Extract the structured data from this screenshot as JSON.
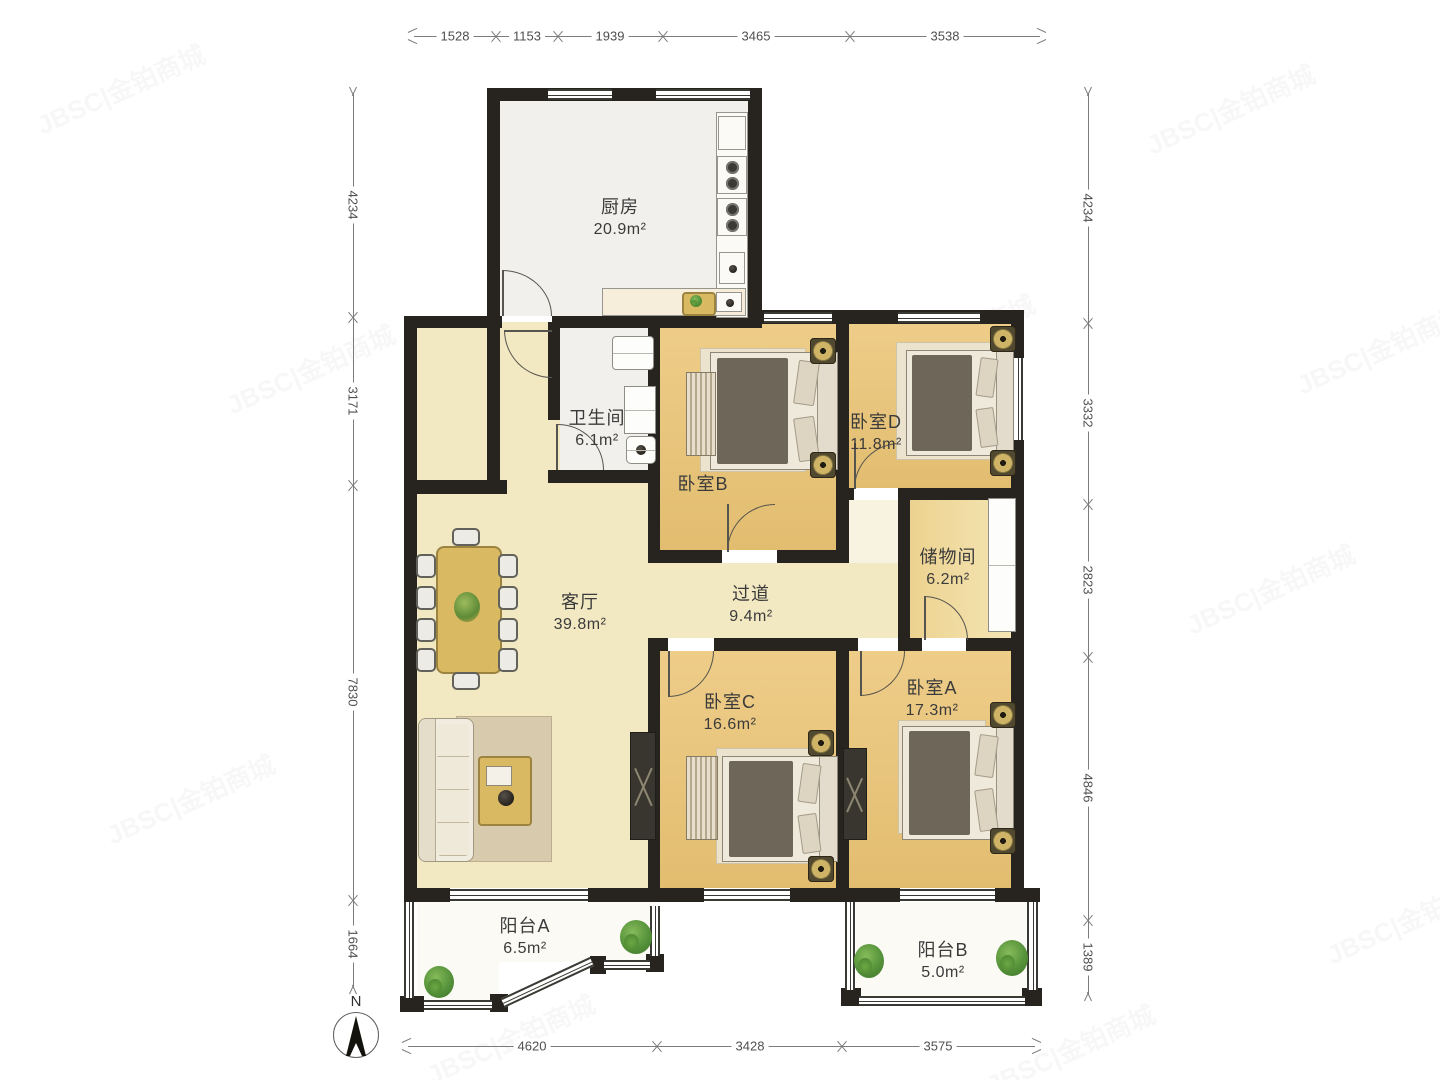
{
  "compass": {
    "label": "N"
  },
  "watermark": {
    "text": "JBSC|金铂商城"
  },
  "rooms": [
    {
      "name": "厨房",
      "area": "20.9m²"
    },
    {
      "name": "卫生间",
      "area": "6.1m²"
    },
    {
      "name": "卧室B",
      "area": ""
    },
    {
      "name": "卧室D",
      "area": "11.8m²"
    },
    {
      "name": "储物间",
      "area": "6.2m²"
    },
    {
      "name": "客厅",
      "area": "39.8m²"
    },
    {
      "name": "过道",
      "area": "9.4m²"
    },
    {
      "name": "卧室C",
      "area": "16.6m²"
    },
    {
      "name": "卧室A",
      "area": "17.3m²"
    },
    {
      "name": "阳台A",
      "area": "6.5m²"
    },
    {
      "name": "阳台B",
      "area": "5.0m²"
    }
  ],
  "dimensions": {
    "top": [
      "1528",
      "1153",
      "1939",
      "3465",
      "3538"
    ],
    "left": [
      "4234",
      "3171",
      "7830",
      "1664"
    ],
    "right": [
      "4234",
      "3332",
      "2823",
      "4846",
      "1389"
    ],
    "bottom": [
      "4620",
      "3428",
      "3575"
    ]
  },
  "colors": {
    "wall": "#272420",
    "bedroom_floor": "#eacb84",
    "living_floor": "#f2e8c2",
    "kitchen_floor": "#f1f0ec",
    "balcony_floor": "#fbfaf5",
    "accent_gold": "#cfb468",
    "plant_green": "#55923a"
  }
}
